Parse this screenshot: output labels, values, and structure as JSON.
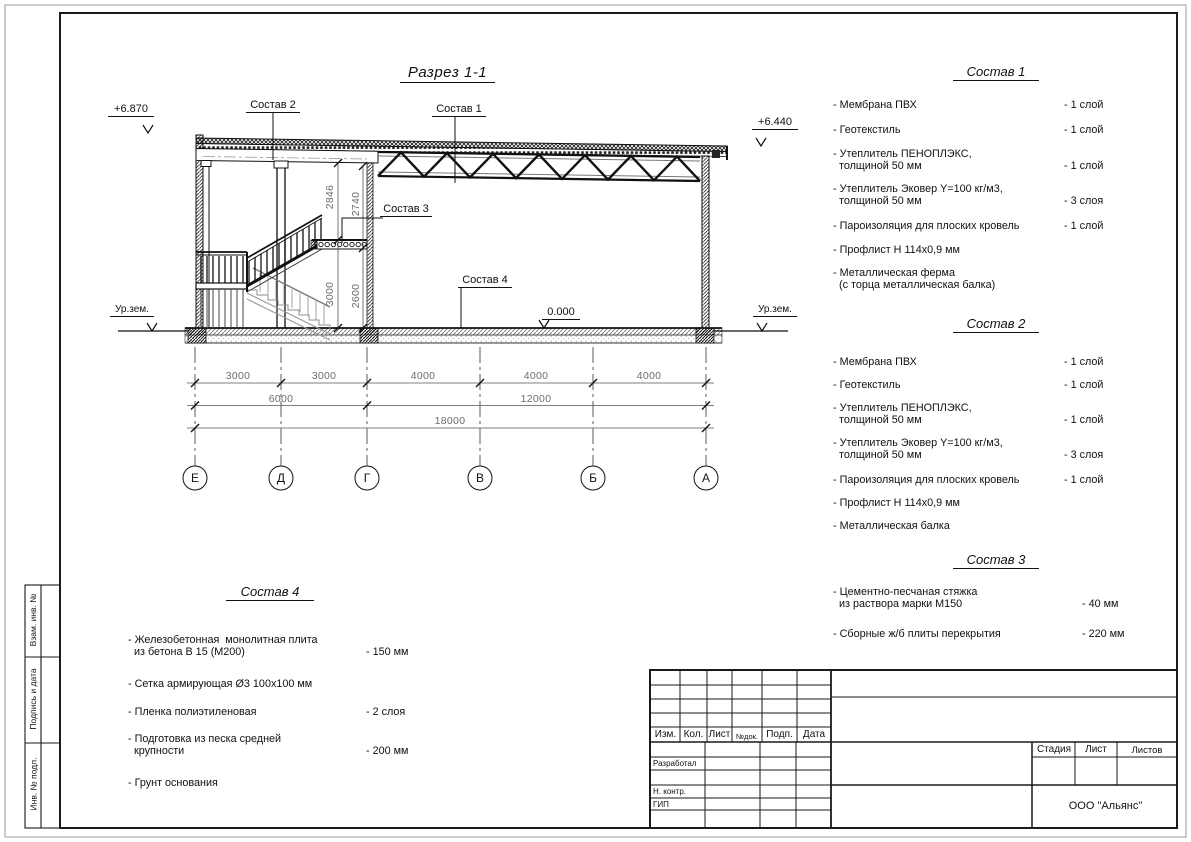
{
  "drawing": {
    "title": "Разрез 1-1",
    "elevation_left": "+6.870",
    "elevation_right": "+6.440",
    "elevation_floor": "0.000",
    "ground_level_left": "Ур.зем.",
    "ground_level_right": "Ур.зем.",
    "leader_sostav_1": "Состав 1",
    "leader_sostav_2": "Состав 2",
    "leader_sostav_3": "Состав 3",
    "leader_sostav_4": "Состав 4",
    "dims_row1": [
      "3000",
      "3000",
      "4000",
      "4000",
      "4000"
    ],
    "dims_row2": [
      "6000",
      "12000"
    ],
    "dims_row3": [
      "18000"
    ],
    "dims_vertical": [
      "2846",
      "2740",
      "3000",
      "2600"
    ],
    "axes": [
      "Е",
      "Д",
      "Г",
      "В",
      "Б",
      "А"
    ]
  },
  "lists": {
    "sostav1": {
      "title": "Состав 1",
      "items": [
        {
          "label": "- Мембрана ПВХ",
          "value": "- 1 слой"
        },
        {
          "label": "- Геотекстиль",
          "value": "- 1 слой"
        },
        {
          "label": "- Утеплитель ПЕНОПЛЭКС,\n  толщиной 50 мм",
          "value": "- 1 слой"
        },
        {
          "label": "- Утеплитель Эковер Y=100 кг/м3,\n  толщиной 50 мм",
          "value": "- 3 слоя"
        },
        {
          "label": "- Пароизоляция для плоских кровель",
          "value": "- 1 слой"
        },
        {
          "label": "- Профлист Н 114х0,9 мм",
          "value": ""
        },
        {
          "label": "- Металлическая ферма\n  (с торца металлическая балка)",
          "value": ""
        }
      ]
    },
    "sostav2": {
      "title": "Состав 2",
      "items": [
        {
          "label": "- Мембрана ПВХ",
          "value": "- 1 слой"
        },
        {
          "label": "- Геотекстиль",
          "value": "- 1 слой"
        },
        {
          "label": "- Утеплитель ПЕНОПЛЭКС,\n  толщиной 50 мм",
          "value": "- 1 слой"
        },
        {
          "label": "- Утеплитель Эковер Y=100 кг/м3,\n  толщиной 50 мм",
          "value": "- 3 слоя"
        },
        {
          "label": "- Пароизоляция для плоских кровель",
          "value": "- 1 слой"
        },
        {
          "label": "- Профлист Н 114х0,9 мм",
          "value": ""
        },
        {
          "label": "- Металлическая балка",
          "value": ""
        }
      ]
    },
    "sostav3": {
      "title": "Состав 3",
      "items": [
        {
          "label": "- Цементно-песчаная стяжка\n  из раствора марки М150",
          "value": "- 40 мм"
        },
        {
          "label": "- Сборные ж/б плиты перекрытия",
          "value": "- 220 мм"
        }
      ]
    },
    "sostav4": {
      "title": "Состав 4",
      "items": [
        {
          "label": "- Железобетонная  монолитная плита\n  из бетона В 15 (М200)",
          "value": "- 150 мм"
        },
        {
          "label": "- Сетка армирующая Ø3 100х100 мм",
          "value": ""
        },
        {
          "label": "- Пленка полиэтиленовая",
          "value": "- 2 слоя"
        },
        {
          "label": "- Подготовка из песка средней\n  крупности",
          "value": "- 200 мм"
        },
        {
          "label": "- Грунт основания",
          "value": ""
        }
      ]
    }
  },
  "titleblock": {
    "header": [
      "Изм.",
      "Кол.",
      "Лист",
      "№док.",
      "Подп.",
      "Дата"
    ],
    "roles": [
      "Разработал",
      "Н. контр.",
      "ГИП"
    ],
    "stage_label": "Стадия",
    "sheet_label": "Лист",
    "sheets_label": "Листов",
    "company": "ООО \"Альянс\""
  },
  "sidebar": {
    "labels": [
      "Взам. инв. №",
      "Подпись и дата",
      "Инв. № подл."
    ]
  }
}
